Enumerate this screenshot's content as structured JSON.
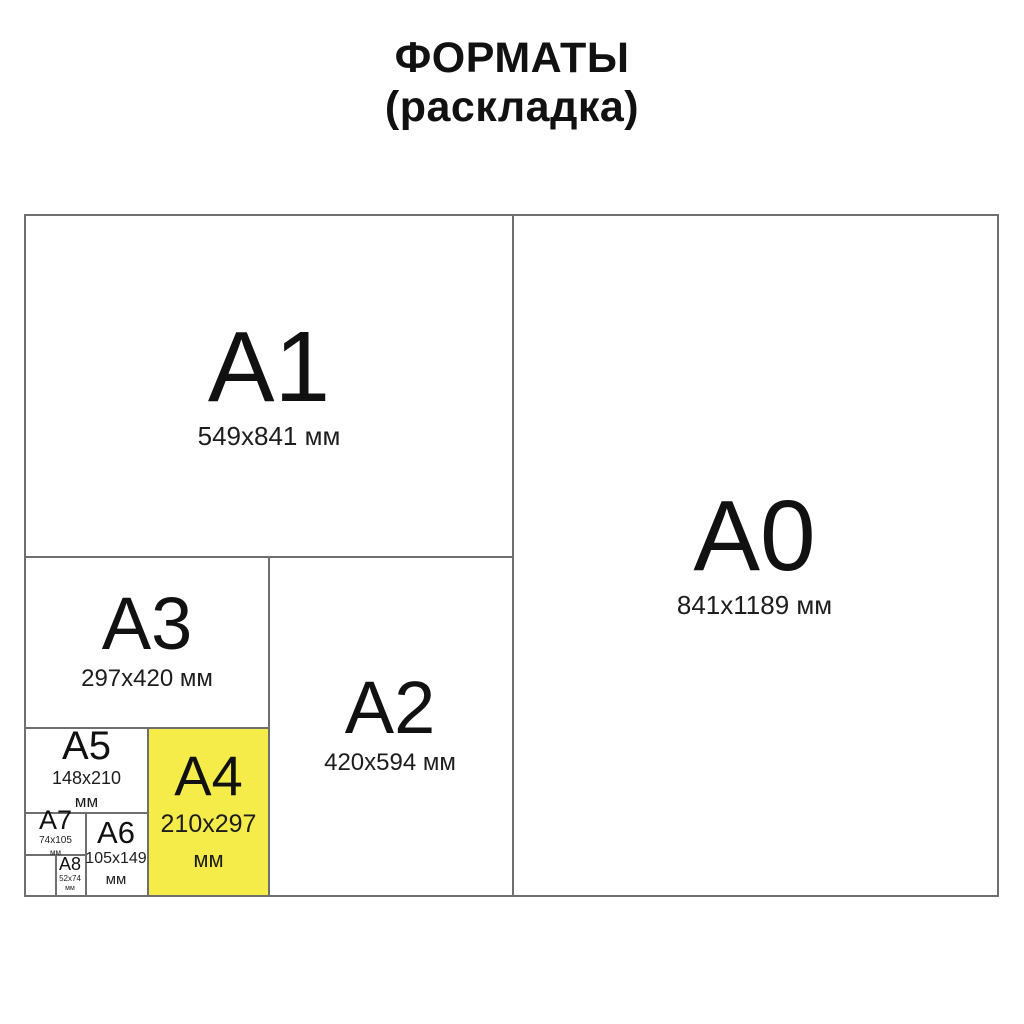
{
  "title": {
    "line1": "ФОРМАТЫ",
    "line2": "(раскладка)"
  },
  "colors": {
    "highlight_yellow": "#f5ec4a",
    "line_gray": "#6f6f6f",
    "text": "#111111",
    "background": "#ffffff"
  },
  "formats": {
    "a0": {
      "label": "A0",
      "size_lines": [
        "841x1189 мм"
      ],
      "highlighted": false
    },
    "a1": {
      "label": "A1",
      "size_lines": [
        "549x841 мм"
      ],
      "highlighted": false
    },
    "a2": {
      "label": "A2",
      "size_lines": [
        "420x594 мм"
      ],
      "highlighted": false
    },
    "a3": {
      "label": "A3",
      "size_lines": [
        "297x420 мм"
      ],
      "highlighted": false
    },
    "a4": {
      "label": "A4",
      "size_lines": [
        "210x297",
        "мм"
      ],
      "highlighted": true
    },
    "a5": {
      "label": "A5",
      "size_lines": [
        "148x210",
        "мм"
      ],
      "highlighted": false
    },
    "a6": {
      "label": "A6",
      "size_lines": [
        "105x149",
        "мм"
      ],
      "highlighted": false
    },
    "a7": {
      "label": "A7",
      "size_lines": [
        "74x105",
        "мм"
      ],
      "highlighted": false
    },
    "a8": {
      "label": "A8",
      "size_lines": [
        "52x74",
        "мм"
      ],
      "highlighted": false
    }
  }
}
